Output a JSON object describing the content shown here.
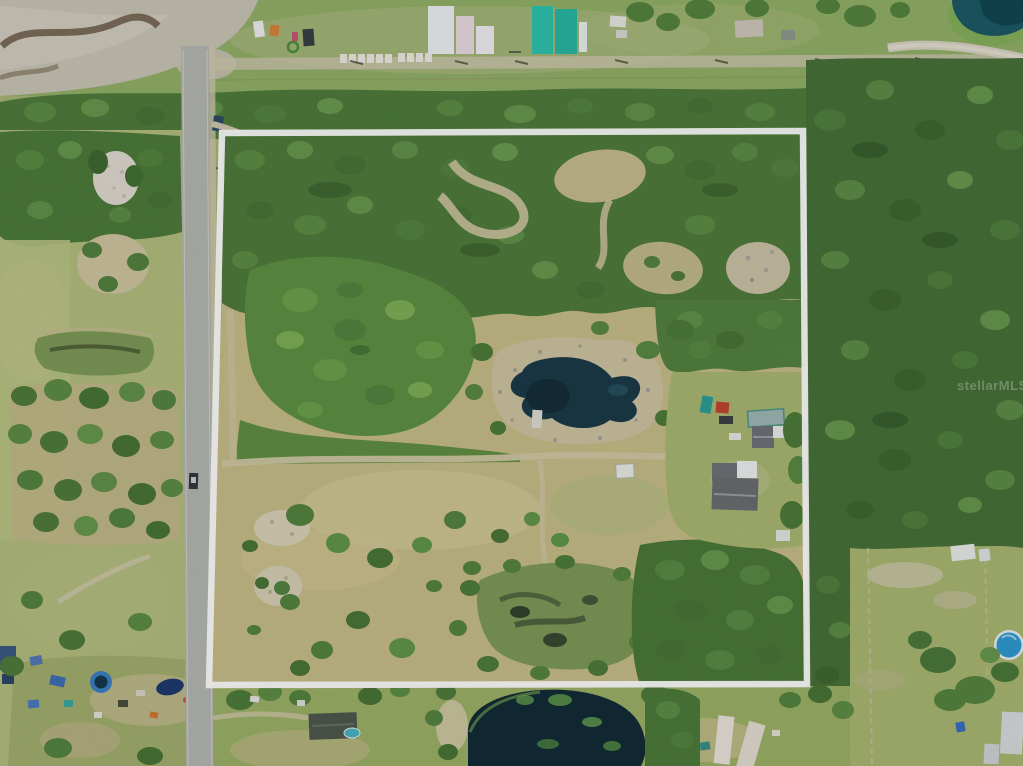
{
  "watermark": {
    "text": "stellarMLS"
  },
  "colors": {
    "grass_base": "#a7b473",
    "grass_top_strip": "#93b069",
    "grass_left": "#b2bd7e",
    "grass_bottom": "#9db167",
    "pasture_tan": "#c8bd8a",
    "clearing_green": "#a9b873",
    "forest_green": "#4f7c3c",
    "forest_right": "#477139",
    "brush_green": "#5e9245",
    "marsh_green": "#7e9a58",
    "road_gray": "#b5b7b1",
    "dirt_gravel": "#c9c5b6",
    "sand_trail": "#d1c8a4",
    "sand_white": "#dfdbd2",
    "pond_shore": "#cdc4a2",
    "boundary_white": "#ffffff",
    "pond_water": "#1d3b49",
    "pond_dark": "#152e3a",
    "pond_teal_edge": "#2a5a68",
    "pond_bottom": "#132c37",
    "pond_top_right": "#1d5a66",
    "pool_blue": "#2f9ad2",
    "pool_small_blue": "#3a80c4",
    "roof_dark_gray": "#6e7276",
    "roof_charcoal": "#50584e",
    "shed_white": "#e9ebe9",
    "trailer_red": "#c0452f",
    "boat_teal": "#2e9e98",
    "material_teal": "#2ec3ae",
    "material_white": "#eef0f4",
    "car_dark_blue": "#2e4a66",
    "tarp_blue": "#3f6fb5",
    "trampoline_navy": "#1f3a6e",
    "orange_item": "#d2762e"
  }
}
